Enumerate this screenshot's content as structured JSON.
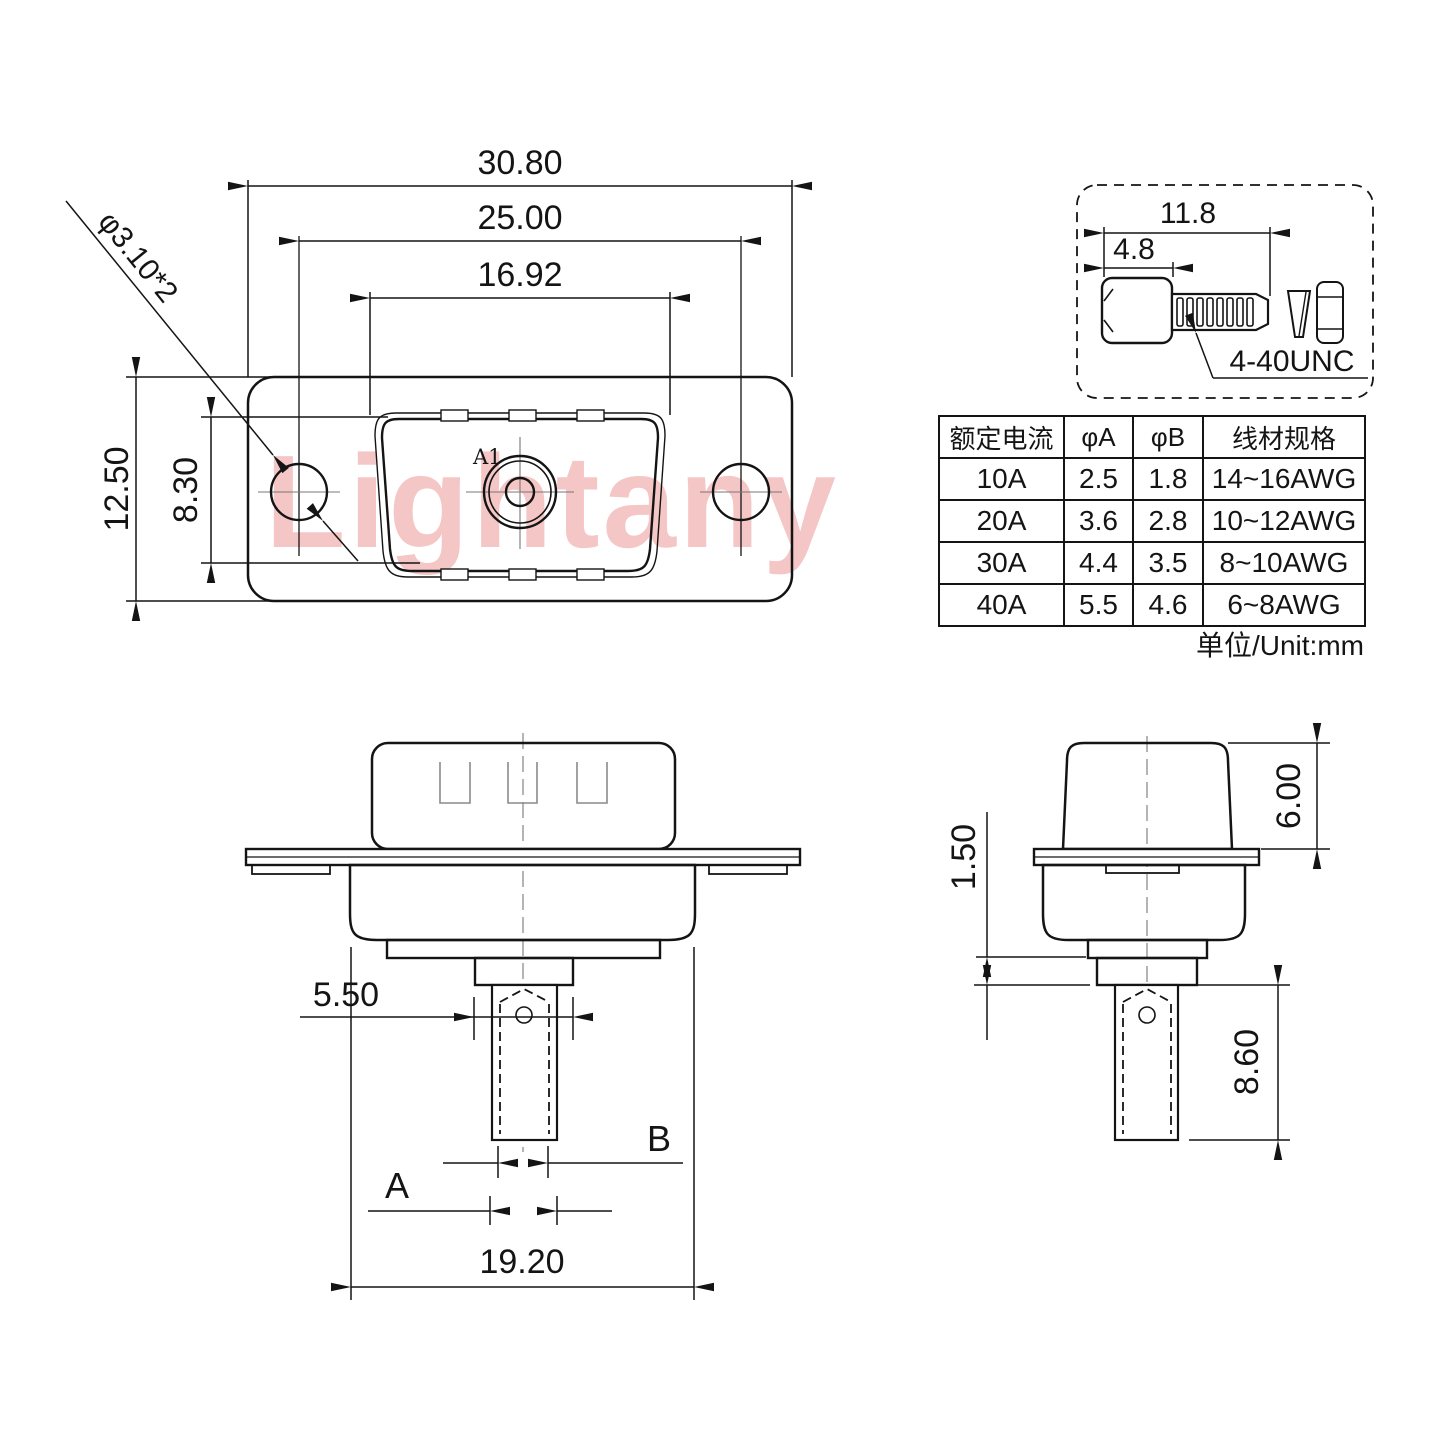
{
  "watermark": "Lightany",
  "front_view": {
    "dim_overall_width": "30.80",
    "dim_hole_spacing": "25.00",
    "dim_insert_width": "16.92",
    "dim_overall_height": "12.50",
    "dim_insert_height": "8.30",
    "mount_hole_label": "φ3.10*2",
    "contact_label": "A1"
  },
  "screw_detail": {
    "dim_total_length": "11.8",
    "dim_head_length": "4.8",
    "thread_spec": "4-40UNC"
  },
  "spec_table": {
    "headers": [
      "额定电流",
      "φA",
      "φB",
      "线材规格"
    ],
    "rows": [
      [
        "10A",
        "2.5",
        "1.8",
        "14~16AWG"
      ],
      [
        "20A",
        "3.6",
        "2.8",
        "10~12AWG"
      ],
      [
        "30A",
        "4.4",
        "3.5",
        "8~10AWG"
      ],
      [
        "40A",
        "5.5",
        "4.6",
        "6~8AWG"
      ]
    ],
    "unit_note": "单位/Unit:mm"
  },
  "rear_view": {
    "dim_step_width": "5.50",
    "dim_body_width": "19.20",
    "dim_label_a": "A",
    "dim_label_b": "B"
  },
  "side_view": {
    "dim_step_height": "1.50",
    "dim_shell_height": "6.00",
    "dim_solder_cup_length": "8.60"
  }
}
